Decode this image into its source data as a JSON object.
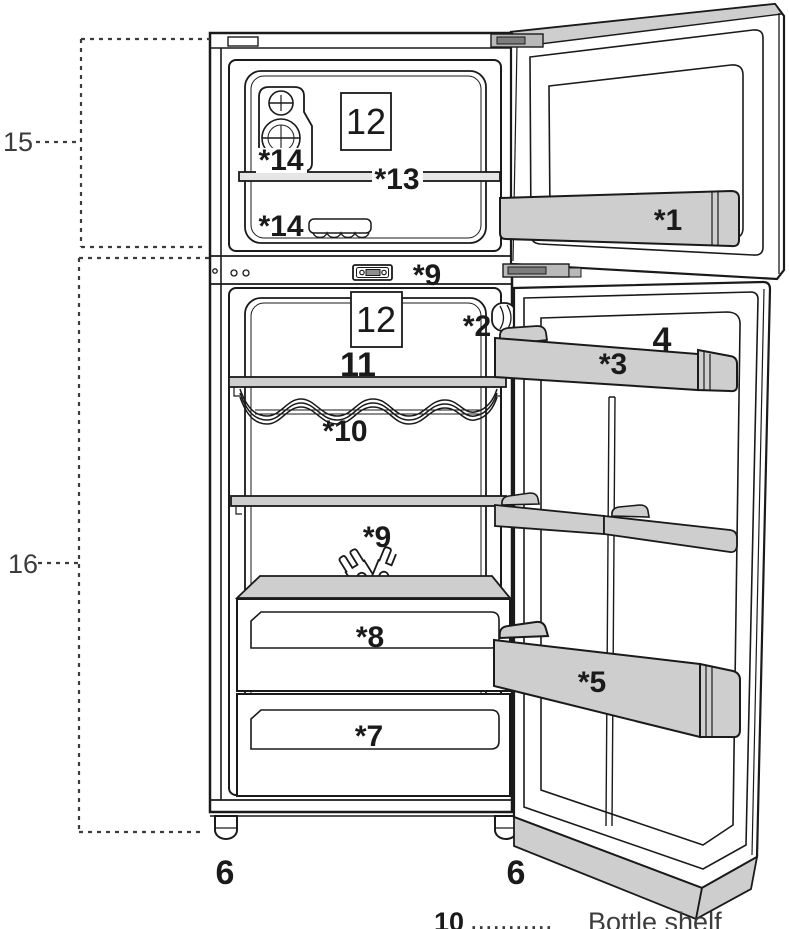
{
  "diagram_title": "Refrigerator parts overview",
  "labels": {
    "measure_upper": "15",
    "measure_lower": "16",
    "foot_left": "6",
    "foot_right": "6",
    "freezer_door_shelf": "*1",
    "lamp": "*2",
    "door_shelf_top": "*3",
    "door_shelf_top_no": "4",
    "door_shelf_bottom": "*5",
    "drawer_lower": "*7",
    "drawer_upper": "*8",
    "control_panel": "*9",
    "keys": "*9",
    "bottle_shelf": "*10",
    "glass_shelf": "11",
    "freezer_card": "12",
    "fridge_card": "12",
    "freezer_shelf": "*13",
    "ice_maker": "*14",
    "ice_tray": "*14"
  },
  "legend": {
    "number": "10",
    "leader": "...........",
    "label": "Bottle shelf"
  },
  "colors": {
    "outline": "#1a1a1a",
    "shelf_gray": "#cecece",
    "hinge_gray": "#b9b9b9",
    "background": "#ffffff"
  }
}
